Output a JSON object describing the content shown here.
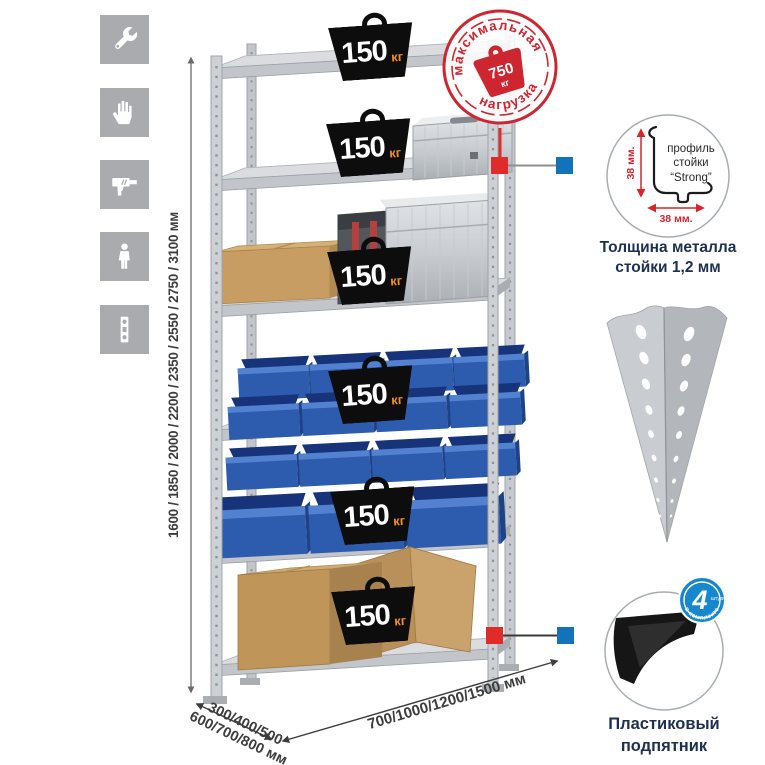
{
  "sidebar": {
    "icons": [
      {
        "name": "wrench-icon"
      },
      {
        "name": "gloves-icon"
      },
      {
        "name": "drill-icon"
      },
      {
        "name": "person-icon"
      },
      {
        "name": "level-icon"
      }
    ]
  },
  "dims": {
    "height": "1600 / 1850 / 2000 / 2200 / 2350 / 2550 / 2750 / 3100 мм",
    "depth1": "300/400/500",
    "depth2": "600/700/800 мм",
    "width": "700/1000/1200/1500 мм"
  },
  "shelf_badges": [
    {
      "value": "150",
      "unit": "кг"
    },
    {
      "value": "150",
      "unit": "кг"
    },
    {
      "value": "150",
      "unit": "кг"
    },
    {
      "value": "150",
      "unit": "кг"
    },
    {
      "value": "150",
      "unit": "кг"
    },
    {
      "value": "150",
      "unit": "кг"
    }
  ],
  "stamp": {
    "arc_top": "максимальная",
    "arc_bottom": "нагрузка",
    "value": "750",
    "unit": "кг"
  },
  "profile": {
    "dim_v": "38 мм.",
    "dim_h": "38 мм.",
    "l1": "профиль",
    "l2": "стойки",
    "l3": "“Strong”",
    "caption1": "Толщина металла",
    "caption2": "стойки 1,2 мм"
  },
  "foot": {
    "badge_value": "4",
    "badge_small": "штуки",
    "badge_arc": "в комплекте",
    "caption1": "Пластиковый",
    "caption2": "подпятник"
  },
  "colors": {
    "stamp_red": "#cd2630",
    "callout_red": "#e02b2b",
    "callout_blue": "#1273ba",
    "badge_orange": "#f28f1f",
    "bin_blue": "#2d5bae",
    "caption_navy": "#1d3050"
  }
}
